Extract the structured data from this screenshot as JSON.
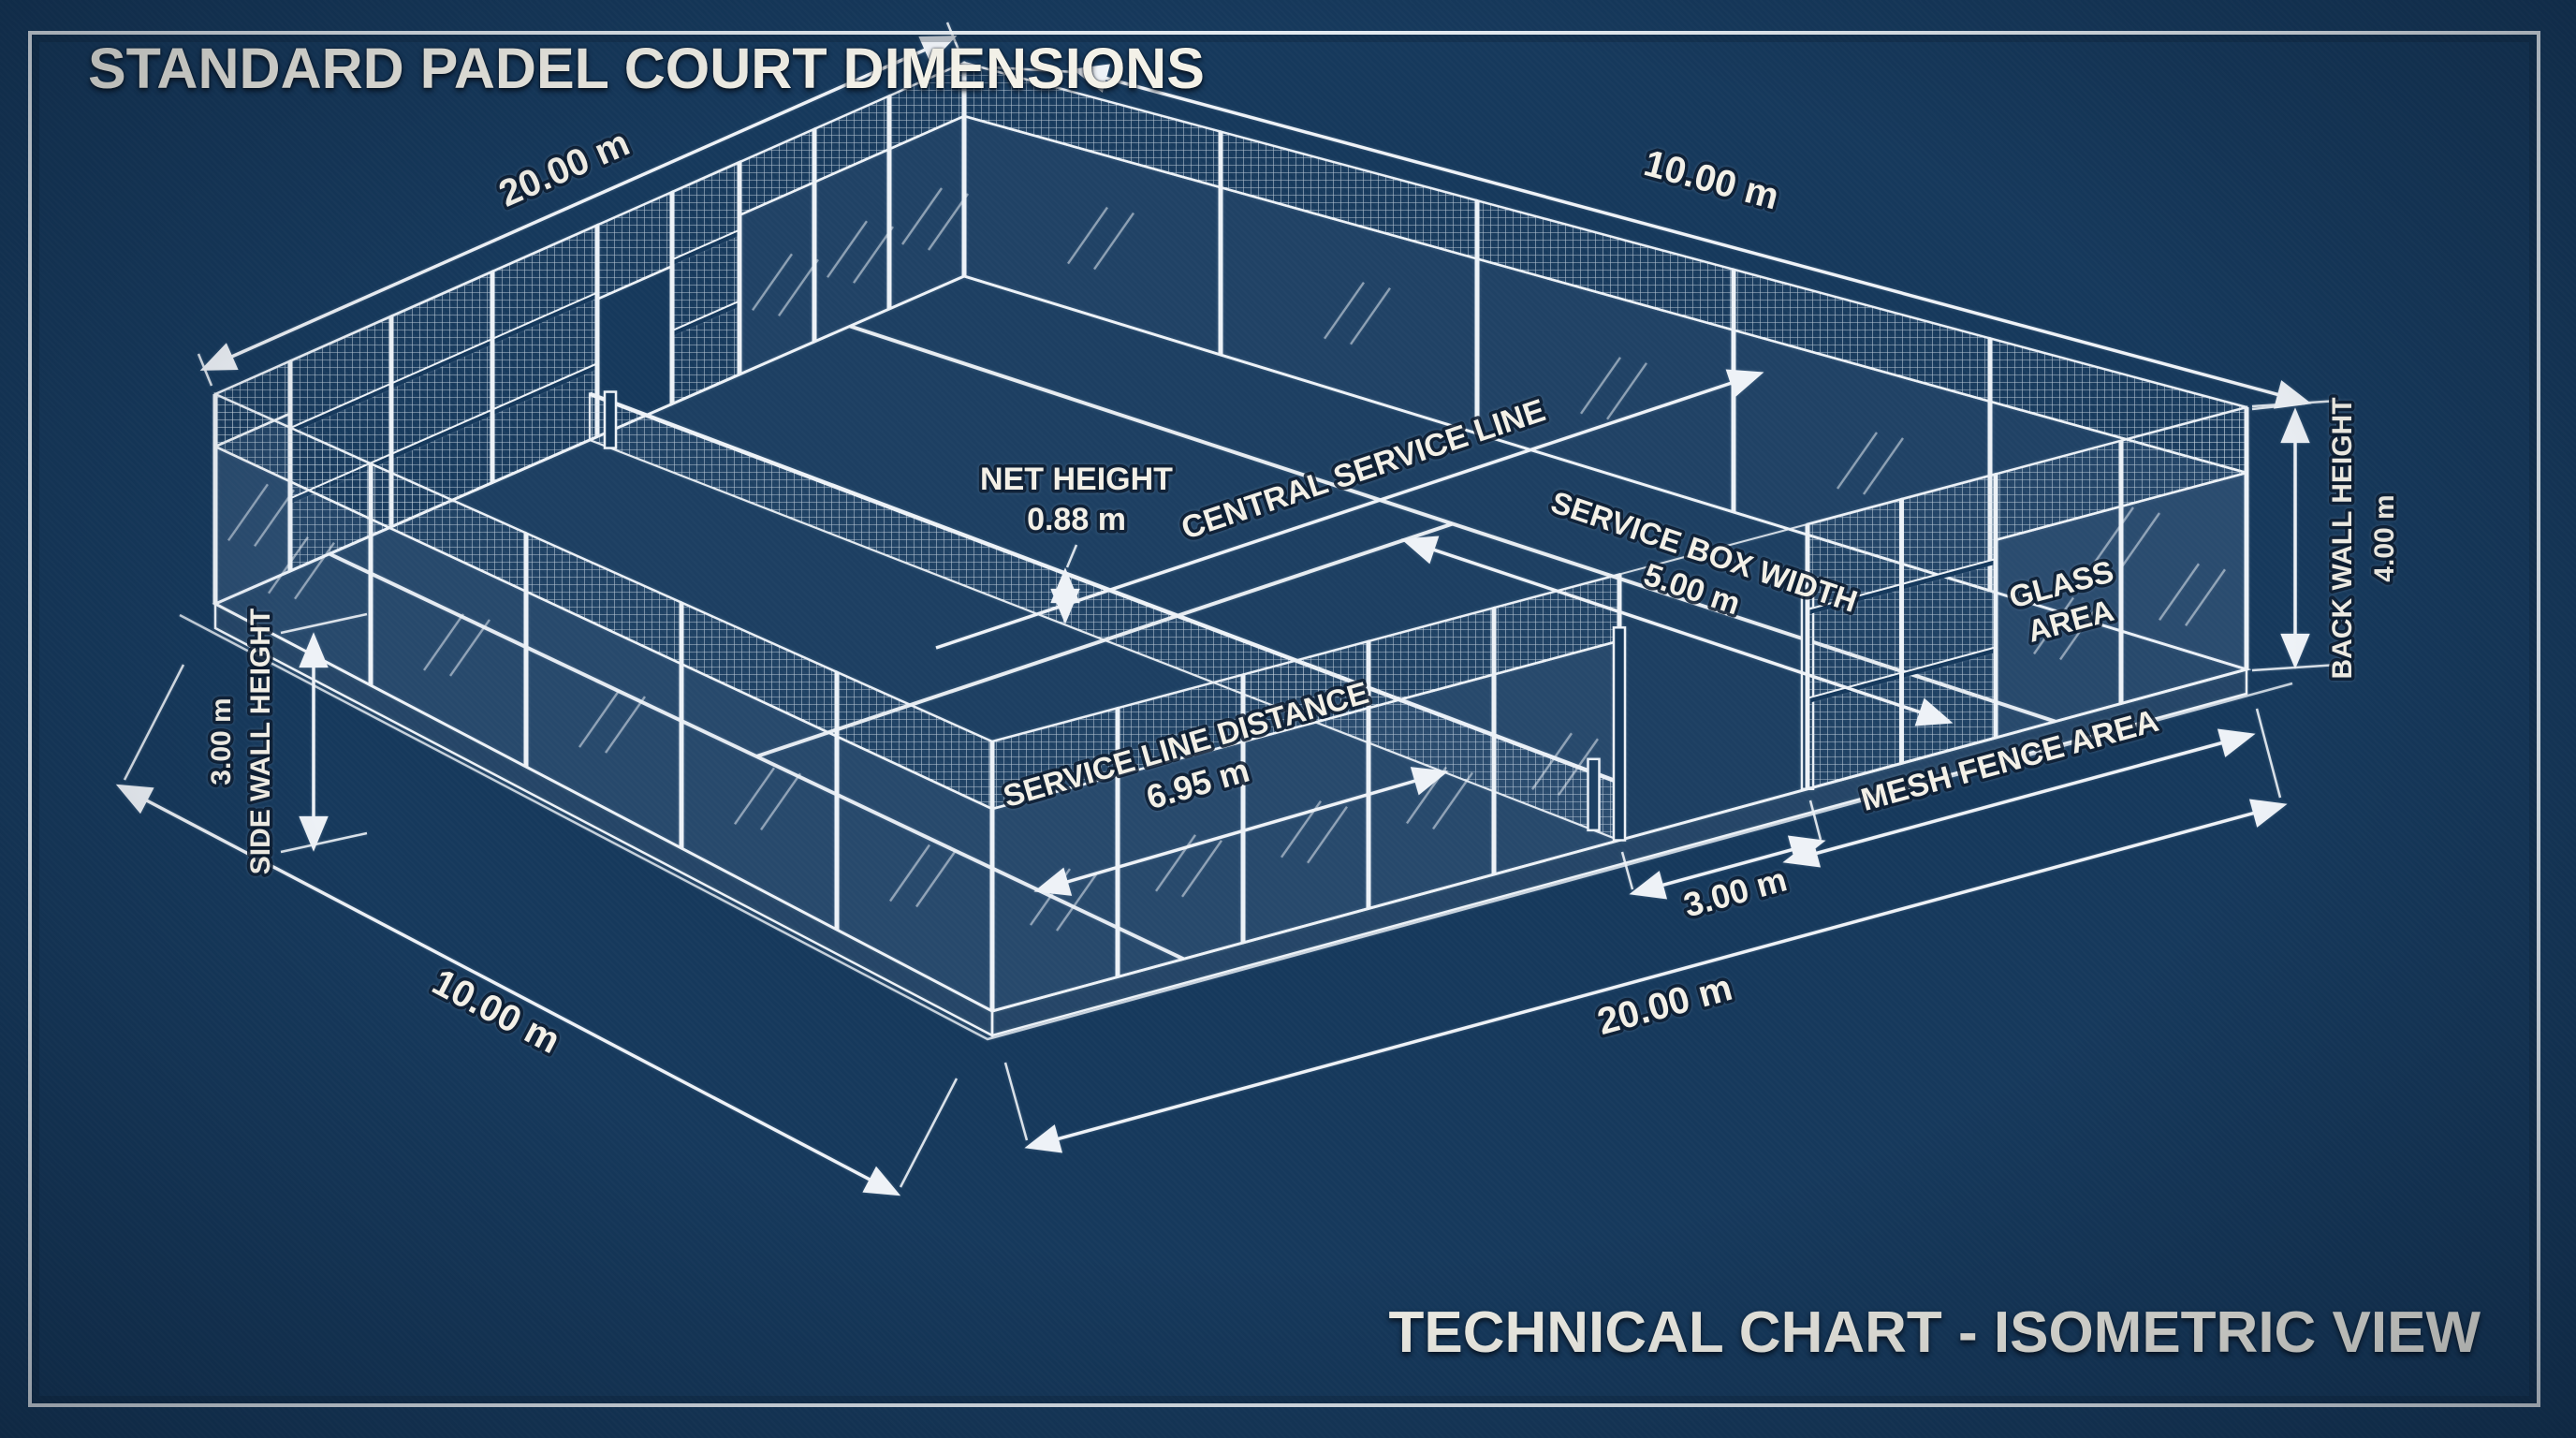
{
  "title": "STANDARD PADEL COURT DIMENSIONS",
  "footer": "TECHNICAL CHART - ISOMETRIC VIEW",
  "labels": {
    "length_top": "20.00 m",
    "width_top": "10.00 m",
    "service_box_width_title": "SERVICE BOX WIDTH",
    "service_box_width_value": "5.00 m",
    "central_service_line": "CENTRAL SERVICE LINE",
    "net_height_title": "NET HEIGHT",
    "net_height_value": "0.88 m",
    "glass_area_line1": "GLASS",
    "glass_area_line2": "AREA",
    "mesh_fence_area": "MESH FENCE AREA",
    "back_wall_height_title": "BACK WALL HEIGHT",
    "back_wall_height_value": "4.00 m",
    "side_wall_height_title": "SIDE WALL HEIGHT",
    "side_wall_height_value": "3.00 m",
    "service_line_distance_title": "SERVICE LINE DISTANCE",
    "service_line_distance_value": "6.95 m",
    "door_width_value": "3.00 m",
    "length_bottom": "20.00 m",
    "width_bottom": "10.00 m"
  },
  "court_dimensions": {
    "court_length_m": 20.0,
    "court_width_m": 10.0,
    "back_wall_height_m": 4.0,
    "side_wall_height_m": 3.0,
    "net_height_m": 0.88,
    "service_line_distance_m": 6.95,
    "service_box_width_m": 5.0,
    "gate_opening_m": 3.0
  },
  "colors": {
    "background": "#16395c",
    "line": "#edf2f7",
    "text": "#f3f0e7"
  },
  "view": "isometric"
}
